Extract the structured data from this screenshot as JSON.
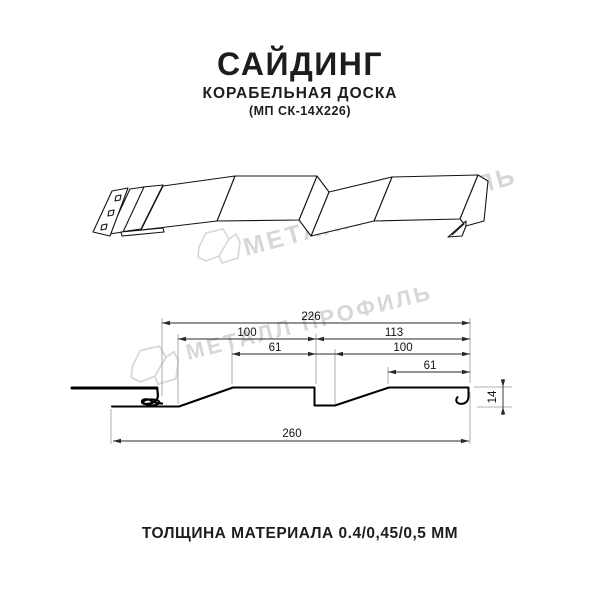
{
  "header": {
    "title": "САЙДИНГ",
    "subtitle": "КОРАБЕЛЬНАЯ ДОСКА",
    "model": "(МП СК-14Х226)"
  },
  "watermark": {
    "text": "МЕТАЛЛ ПРОФИЛЬ",
    "color": "#d7d7d7",
    "logo": "metall-profil-logo"
  },
  "dimensions": {
    "overall_width_top": "226",
    "left_board_width": "100",
    "right_board_width": "113",
    "left_flat_width": "61",
    "right_board_inner_width": "100",
    "right_flat_width": "61",
    "full_width_bottom": "260",
    "profile_height": "14"
  },
  "footer": {
    "thickness_label": "ТОЛЩИНА МАТЕРИАЛА 0.4/0,45/0,5 ММ"
  },
  "drawing": {
    "line_color": "#101010",
    "dim_line_color": "#2a2a2a",
    "extension_line_color": "#9a9a9a"
  }
}
